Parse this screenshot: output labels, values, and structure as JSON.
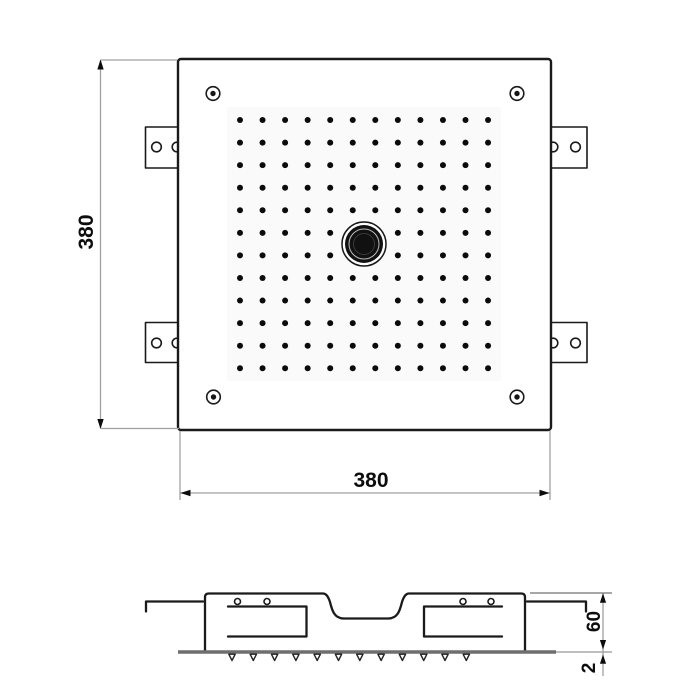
{
  "colors": {
    "line": "#1a1a1a",
    "dim_line": "#a0a0a0",
    "arrow_text": "#0d0d0d",
    "faceplate_edge": "#6e6e6e"
  },
  "top_view": {
    "width_dim_label": "380",
    "height_dim_label": "380",
    "corner_screw_count": 4,
    "mounting_tab_count": 4,
    "grid": {
      "rows": 12,
      "cols": 12,
      "origin_x": 240,
      "origin_y": 120,
      "step_x": 22.55,
      "step_y": 22.57,
      "dot_radius": 3,
      "skip": [
        [
          5,
          5
        ],
        [
          5,
          6
        ],
        [
          6,
          5
        ],
        [
          6,
          6
        ]
      ]
    }
  },
  "side_view": {
    "height_dim_label": "60",
    "thickness_dim_label": "2",
    "nozzles": {
      "count": 12,
      "start_x": 232,
      "step": 21.3,
      "y_top": 654.2,
      "height": 6.3,
      "half_width": 3.2
    }
  }
}
